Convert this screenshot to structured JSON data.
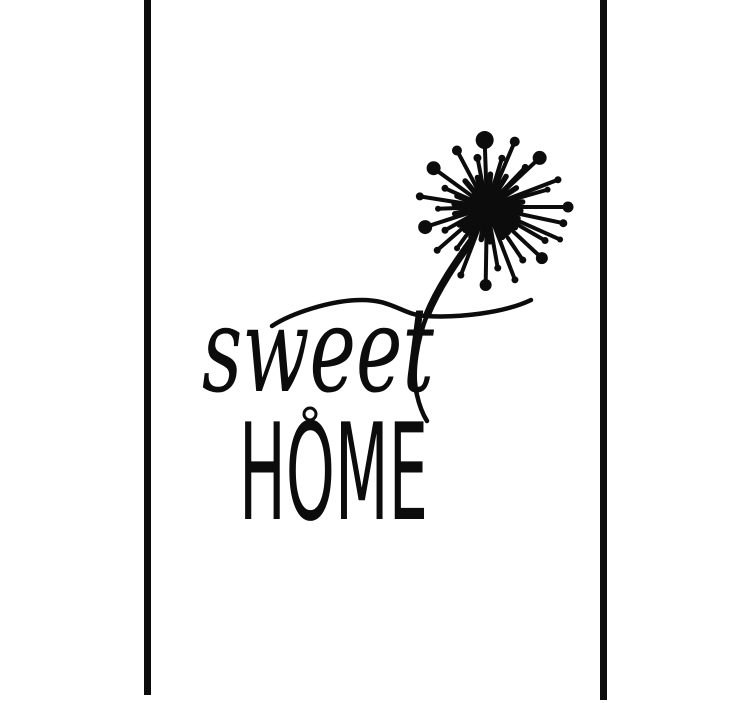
{
  "page": {
    "background_color": "#ffffff",
    "ink_color": "#0c0c0c"
  },
  "poster": {
    "script_word": "sweet",
    "caps_word": "HOME",
    "dandelion": {
      "center": {
        "x": 487,
        "y": 207
      },
      "core_radius": 20,
      "rays": [
        [
          -92,
          67,
          9
        ],
        [
          -67,
          71,
          5
        ],
        [
          -118,
          64,
          5
        ],
        [
          -43,
          72,
          7
        ],
        [
          -144,
          66,
          7
        ],
        [
          -101,
          50,
          4
        ],
        [
          -73,
          51,
          3.5
        ],
        [
          -46,
          55,
          3.5
        ],
        [
          -156,
          46,
          3.5
        ],
        [
          -21,
          76,
          3.5
        ],
        [
          -171,
          68,
          4
        ],
        [
          -16,
          63,
          3
        ],
        [
          0,
          81,
          5.5
        ],
        [
          178,
          49,
          3
        ],
        [
          162,
          65,
          7
        ],
        [
          151,
          48,
          3.5
        ],
        [
          139,
          66,
          3.5
        ],
        [
          126,
          51,
          3
        ],
        [
          111,
          73,
          3.5
        ],
        [
          91,
          78,
          6
        ],
        [
          80,
          62,
          3.5
        ],
        [
          69,
          78,
          3.5
        ],
        [
          56,
          64,
          3.5
        ],
        [
          43,
          75,
          6
        ],
        [
          30,
          67,
          3.5
        ],
        [
          24,
          80,
          3
        ],
        [
          12,
          78,
          4
        ],
        [
          -130,
          34,
          0
        ],
        [
          -108,
          31,
          0
        ],
        [
          -84,
          33,
          0
        ],
        [
          -58,
          36,
          0
        ],
        [
          -33,
          35,
          0
        ],
        [
          -8,
          36,
          0
        ],
        [
          6,
          34,
          0
        ],
        [
          20,
          33,
          0
        ],
        [
          36,
          35,
          0
        ],
        [
          50,
          33,
          0
        ],
        [
          63,
          34,
          0
        ],
        [
          85,
          35,
          0
        ],
        [
          100,
          33,
          0
        ],
        [
          118,
          34,
          0
        ],
        [
          133,
          32,
          0
        ],
        [
          147,
          33,
          0
        ],
        [
          168,
          33,
          0
        ],
        [
          -160,
          32,
          0
        ],
        [
          -175,
          33,
          0
        ]
      ]
    }
  }
}
